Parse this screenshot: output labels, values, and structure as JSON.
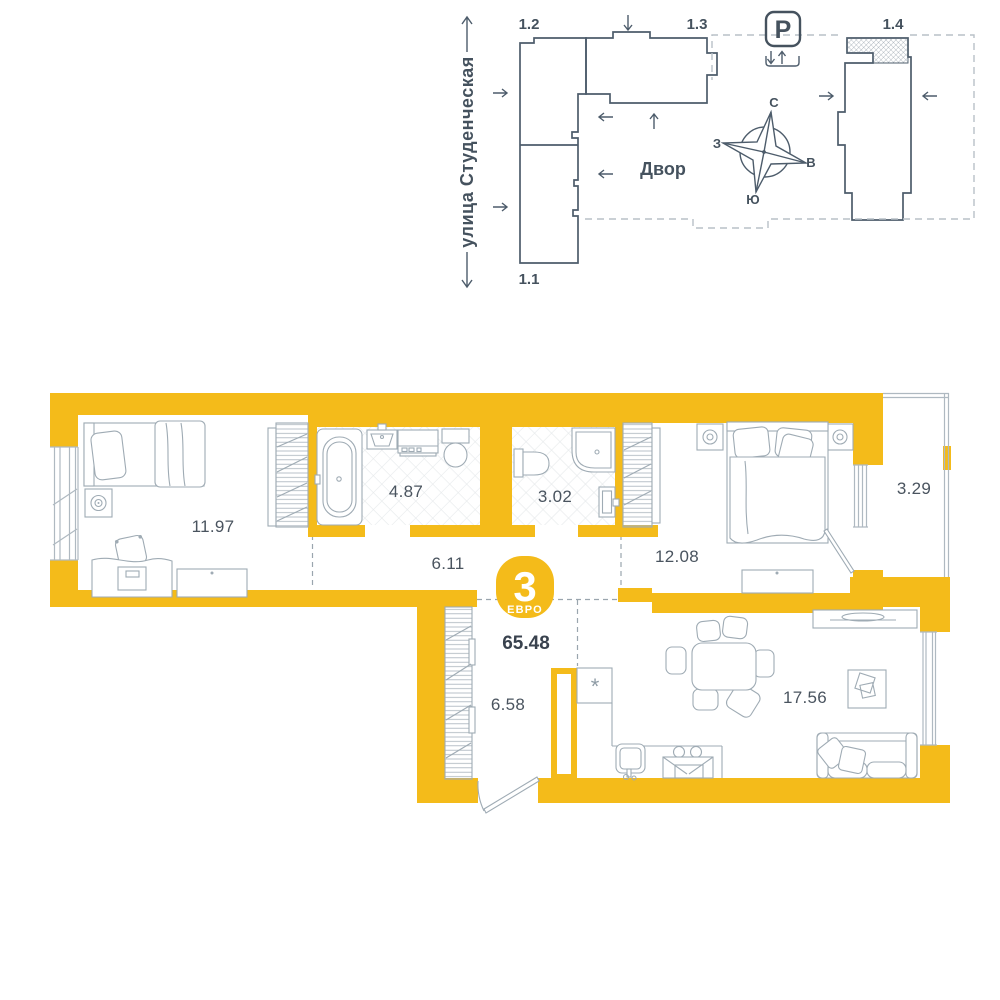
{
  "site_plan": {
    "street_label": "улица Студенческая",
    "courtyard_label": "Двор",
    "parking_label": "P",
    "building_labels": {
      "b11": "1.1",
      "b12": "1.2",
      "b13": "1.3",
      "b14": "1.4"
    },
    "compass": {
      "north": "С",
      "south": "Ю",
      "west": "З",
      "east": "В"
    }
  },
  "floor_plan": {
    "badge": {
      "rooms_number": "3",
      "type_label": "ЕВРО"
    },
    "total_area": "65.48",
    "fridge_marker": "*",
    "rooms": [
      {
        "id": "bedroom-1",
        "area": "11.97"
      },
      {
        "id": "bathroom",
        "area": "4.87"
      },
      {
        "id": "wc",
        "area": "3.02"
      },
      {
        "id": "hallway",
        "area": "6.11"
      },
      {
        "id": "bedroom-2",
        "area": "12.08"
      },
      {
        "id": "balcony",
        "area": "3.29"
      },
      {
        "id": "entry-hall",
        "area": "6.58"
      },
      {
        "id": "kitchen-living-room",
        "area": "17.56"
      }
    ]
  },
  "colors": {
    "wall_accent": "#F4BB1A",
    "site_line": "#4D5C6B",
    "furniture_line": "#9FABB4",
    "label_text": "#4A545F",
    "tile_line": "#E6E9EB",
    "boundary_dash": "#B8C0C7"
  }
}
